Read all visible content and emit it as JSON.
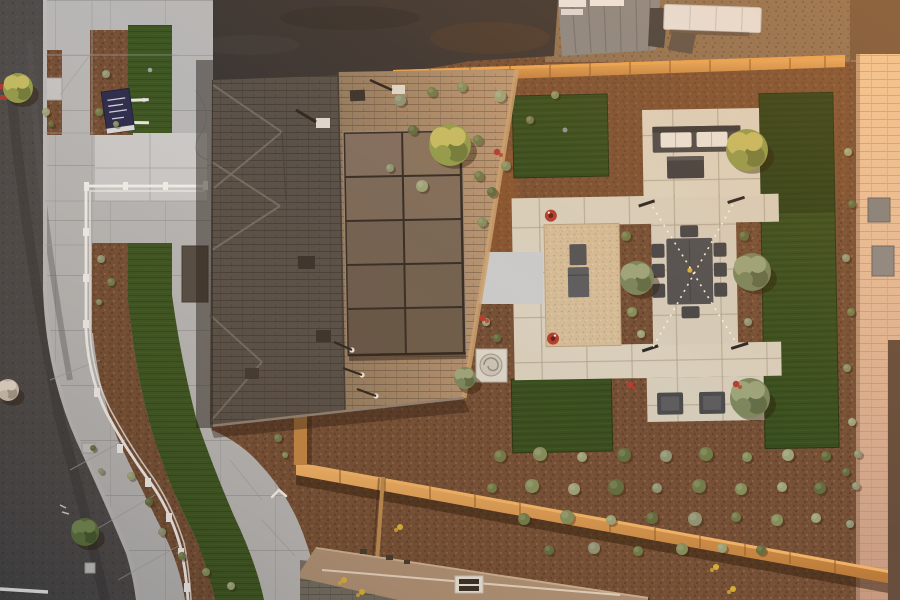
{
  "scene": {
    "type": "aerial-drone-photograph",
    "subject": "new-construction model home with xeriscape landscaping, viewed top-down at golden hour",
    "lighting": "warm low-angle sunlight from upper right, long shadows",
    "no_visible_legible_text": true
  },
  "palette": {
    "mulch": "#6e4c36",
    "mulch_lit": "#a05c2e",
    "charcoal_dirt": "#333234",
    "tan_dirt": "#8a7157",
    "asphalt": "#45474b",
    "curb": "#b9bcc0",
    "sidewalk": "#b4b8bc",
    "walkway_bright": "#c8ccd0",
    "paver": "#d6d1c2",
    "gravel": "#d2bd9c",
    "turf": "#2e4a1e",
    "turf_ribbon": "#335222",
    "roof_shadow": "#524e4a",
    "roof_lit": "#a1866a",
    "roof_eave": "#c9a273",
    "solar_panel": "#6e5f53",
    "wood_fence": "#cd8f4c",
    "wood_fence_lit": "#eaa653",
    "block_wall": "#e3c3a4",
    "white_fence": "#f2f3f4",
    "furniture_dark": "#43474d",
    "cushion_white": "#e8e6e0",
    "sign_navy": "#23284f",
    "metal_roof": "#83878b",
    "trailer_white": "#e5e6e7",
    "utility_box": "#d9d7d0",
    "flower_red": "#b03a30",
    "flower_yellow": "#d8b13a"
  },
  "house": {
    "solar_array": {
      "columns": 2,
      "rows": 5
    },
    "roof_style": "hip roof, shaded left slope, sunlit right slope"
  },
  "backyard": {
    "turf_panels": 3,
    "patio": "paver ring with pea-gravel court, outdoor sofa, coffee table, 8-seat dining table, 2 lounge chairs, grill",
    "string_lights": "X pattern over dining area",
    "red_planter_pots": 2
  },
  "front_yard": {
    "sign": {
      "color_key": "sign_navy",
      "text_legible": false
    },
    "white_rail_fence": "curved two-rail fence along sidewalk"
  },
  "tree_colors": {
    "olive": {
      "main": "#76855f",
      "light": "#98a57d",
      "dark": "#5c6b48"
    },
    "warm": {
      "main": "#8f9c4e",
      "light": "#c2bd66",
      "dark": "#6d7c3c"
    },
    "green": {
      "main": "#54713f",
      "light": "#6f8a55",
      "dark": "#3f5830"
    },
    "pale": {
      "main": "#cfc5ba",
      "light": "#e8dfd4",
      "dark": "#a89c90"
    }
  },
  "shrub_colors": [
    "#6b7a4a",
    "#7e8e5e",
    "#98a37b",
    "#5c6b3f",
    "#8a9477"
  ],
  "vegetation": {
    "trees": [
      [
        450,
        145,
        21,
        "warm"
      ],
      [
        747,
        150,
        21,
        "warm"
      ],
      [
        637,
        278,
        17,
        "olive"
      ],
      [
        752,
        272,
        19,
        "olive"
      ],
      [
        750,
        398,
        20,
        "olive"
      ],
      [
        85,
        532,
        14,
        "green"
      ],
      [
        18,
        88,
        15,
        "warm"
      ],
      [
        8,
        390,
        11,
        "pale"
      ],
      [
        465,
        378,
        11,
        "olive"
      ]
    ],
    "shrubs": [
      [
        500,
        456,
        6
      ],
      [
        540,
        454,
        7
      ],
      [
        582,
        457,
        5
      ],
      [
        624,
        455,
        7
      ],
      [
        666,
        456,
        6
      ],
      [
        706,
        454,
        7
      ],
      [
        747,
        457,
        5
      ],
      [
        788,
        455,
        6
      ],
      [
        826,
        456,
        5
      ],
      [
        858,
        454,
        4
      ],
      [
        492,
        488,
        5
      ],
      [
        532,
        486,
        7
      ],
      [
        574,
        489,
        6
      ],
      [
        616,
        487,
        8
      ],
      [
        657,
        488,
        5
      ],
      [
        699,
        486,
        7
      ],
      [
        741,
        489,
        6
      ],
      [
        782,
        487,
        5
      ],
      [
        820,
        488,
        6
      ],
      [
        856,
        486,
        4
      ],
      [
        524,
        519,
        6
      ],
      [
        567,
        517,
        7
      ],
      [
        611,
        520,
        5
      ],
      [
        652,
        518,
        6
      ],
      [
        695,
        519,
        7
      ],
      [
        736,
        517,
        5
      ],
      [
        777,
        520,
        6
      ],
      [
        816,
        518,
        5
      ],
      [
        549,
        550,
        5
      ],
      [
        594,
        548,
        6
      ],
      [
        638,
        551,
        5
      ],
      [
        682,
        549,
        6
      ],
      [
        722,
        548,
        5
      ],
      [
        761,
        550,
        5
      ],
      [
        400,
        100,
        6
      ],
      [
        432,
        92,
        5
      ],
      [
        462,
        87,
        5
      ],
      [
        500,
        96,
        6
      ],
      [
        413,
        130,
        5
      ],
      [
        446,
        150,
        7
      ],
      [
        478,
        140,
        5
      ],
      [
        506,
        166,
        5
      ],
      [
        422,
        186,
        6
      ],
      [
        492,
        192,
        5
      ],
      [
        390,
        168,
        4
      ],
      [
        530,
        120,
        4
      ],
      [
        555,
        95,
        4
      ],
      [
        848,
        152,
        4
      ],
      [
        852,
        204,
        4
      ],
      [
        846,
        258,
        4
      ],
      [
        851,
        312,
        4
      ],
      [
        847,
        368,
        4
      ],
      [
        852,
        422,
        4
      ],
      [
        846,
        472,
        4
      ],
      [
        850,
        524,
        4
      ],
      [
        626,
        236,
        5
      ],
      [
        632,
        312,
        5
      ],
      [
        641,
        334,
        4
      ],
      [
        744,
        236,
        5
      ],
      [
        748,
        322,
        4
      ],
      [
        479,
        176,
        5
      ],
      [
        482,
        222,
        5
      ],
      [
        486,
        322,
        4
      ],
      [
        497,
        338,
        4
      ],
      [
        106,
        74,
        4
      ],
      [
        99,
        112,
        4
      ],
      [
        116,
        124,
        3
      ],
      [
        46,
        112,
        4
      ],
      [
        51,
        124,
        3
      ],
      [
        101,
        259,
        4
      ],
      [
        111,
        282,
        4
      ],
      [
        99,
        302,
        3
      ],
      [
        131,
        476,
        4
      ],
      [
        149,
        502,
        4
      ],
      [
        162,
        532,
        4
      ],
      [
        182,
        556,
        4
      ],
      [
        206,
        572,
        4
      ],
      [
        231,
        586,
        4
      ],
      [
        93,
        448,
        3
      ],
      [
        101,
        471,
        3
      ],
      [
        278,
        438,
        4
      ],
      [
        285,
        455,
        3
      ]
    ],
    "flowers_red": [
      [
        483,
        318
      ],
      [
        497,
        152
      ],
      [
        630,
        385
      ],
      [
        736,
        384
      ]
    ],
    "flowers_yellow": [
      [
        400,
        527
      ],
      [
        344,
        580
      ],
      [
        716,
        567
      ],
      [
        733,
        589
      ],
      [
        362,
        592
      ]
    ]
  }
}
